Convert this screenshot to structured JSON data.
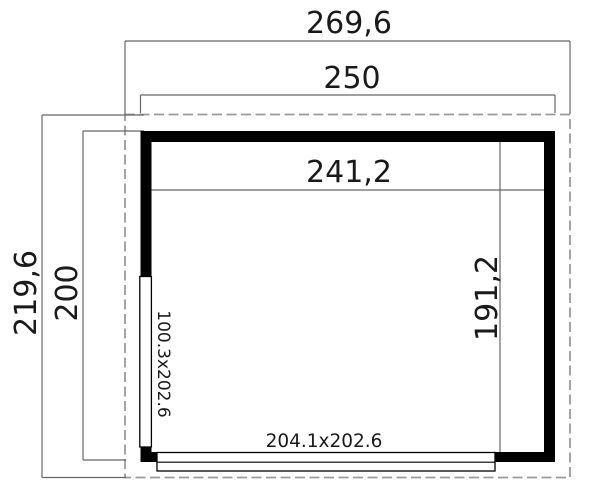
{
  "drawing": {
    "type": "floor-plan",
    "dims": {
      "outer_width": "269,6",
      "base_width": "250",
      "inner_width": "241,2",
      "outer_depth": "219,6",
      "base_depth": "200",
      "inner_depth": "191,2"
    },
    "openings": {
      "side_door_size": "100.3x202.6",
      "front_door_size": "204.1x202.6"
    },
    "colors": {
      "wall": "#000000",
      "dimension_line": "#666666",
      "dashed_outline": "#9a9a9a",
      "text": "#1a1a1a",
      "background": "#ffffff"
    }
  }
}
